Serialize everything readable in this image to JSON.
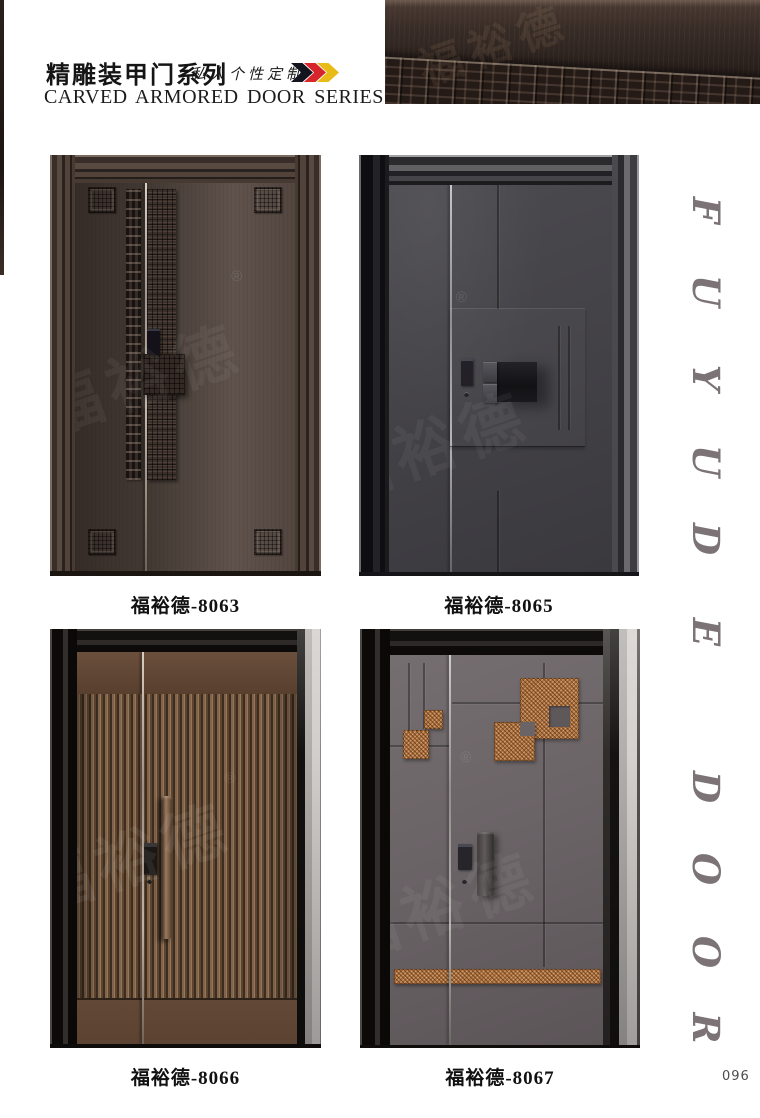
{
  "header": {
    "series_title_cn": "精雕装甲门系列",
    "series_subtitle_cn": "私人个性定制",
    "series_title_en": "CARVED ARMORED DOOR SERIES",
    "chevron_colors": [
      "#14141e",
      "#d6252b",
      "#e8bb16"
    ]
  },
  "watermark_text": "福裕德",
  "registered_mark": "®",
  "products": [
    {
      "model": "福裕德-8063",
      "slab_color": "#4a3e38"
    },
    {
      "model": "福裕德-8065",
      "slab_color": "#454449"
    },
    {
      "model": "福裕德-8066",
      "slab_color": "#7a5c43"
    },
    {
      "model": "福裕德-8067",
      "slab_color": "#6b6467"
    }
  ],
  "side_brand": {
    "text": "FUYUDE DOOR",
    "letters": [
      "F",
      "U",
      "Y",
      "U",
      "D",
      "E",
      "D",
      "O",
      "O",
      "R"
    ],
    "color": "#7b7376"
  },
  "accents": {
    "copper": "#a86f3e",
    "bronze": "#7a5c43"
  },
  "page_number": "096"
}
